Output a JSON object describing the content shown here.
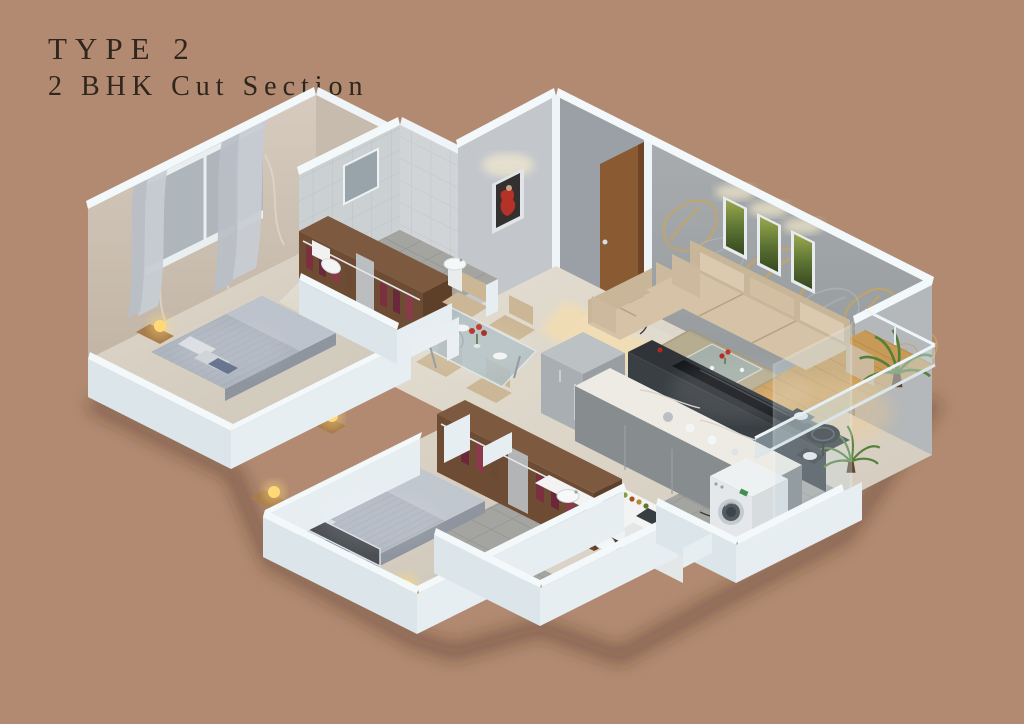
{
  "title": {
    "line1": "TYPE 2",
    "line2": "2 BHK Cut Section"
  },
  "palette": {
    "background": "#b18a71",
    "title_text": "#2f261e",
    "wall_white": "#e7eef2",
    "wall_cap": "#f3f8fa",
    "wallpaper_gray": "#9ea2a4",
    "gold_accent": "#c9a55e",
    "wallpaper_beige": "#cfc4b7",
    "bath_tile_wall": "#ced2d4",
    "floor_beige": "#dad3c6",
    "floor_tile_gray": "#a4a4a1",
    "balcony_wood": "#c89a57",
    "door_wood": "#8a5a33",
    "wardrobe_wood": "#6e4c33",
    "clothes_maroon": "#7b3040",
    "bed_fabric": "#aeb5bf",
    "sofa_beige": "#d2bfa2",
    "tv_dark": "#2f3338",
    "appliance_steel": "#a6acaf",
    "marble_top": "#edebe4",
    "cabinet_gray": "#878c8f",
    "plant_green": "#557f3b",
    "lamp_glow": "#ffd978",
    "artwork_red": "#b43228",
    "painting_green": "#5d7434"
  },
  "scene": {
    "style": "isometric 3D cut-section floor plan render",
    "rooms": [
      {
        "name": "living-room",
        "furniture": [
          "three-seat-sofa",
          "two-seat-sofa",
          "coffee-table",
          "rug",
          "tv-console",
          "wall-paintings",
          "gold-wallpaper"
        ]
      },
      {
        "name": "foyer",
        "furniture": [
          "entrance-door",
          "red-artwork"
        ]
      },
      {
        "name": "dining-area",
        "furniture": [
          "glass-dining-table",
          "four-chairs",
          "flower-vase"
        ]
      },
      {
        "name": "kitchen",
        "furniture": [
          "fridge",
          "island-counter",
          "hob-counter",
          "sink",
          "spice-jars"
        ]
      },
      {
        "name": "bedroom-1",
        "furniture": [
          "double-bed",
          "wardrobe",
          "curtained-window",
          "bedside-lamps"
        ]
      },
      {
        "name": "bathroom-1",
        "furniture": [
          "toilet",
          "washbasin",
          "mirror"
        ]
      },
      {
        "name": "bedroom-2",
        "furniture": [
          "double-bed",
          "wardrobe",
          "tv-ledge",
          "bedside-lamps"
        ]
      },
      {
        "name": "bathroom-2",
        "furniture": [
          "toilet",
          "washbasin-counter"
        ]
      },
      {
        "name": "utility",
        "furniture": [
          "washing-machine"
        ]
      },
      {
        "name": "balcony",
        "furniture": [
          "potted-plants",
          "bistro-table",
          "bistro-chairs",
          "glass-railing"
        ]
      }
    ]
  }
}
